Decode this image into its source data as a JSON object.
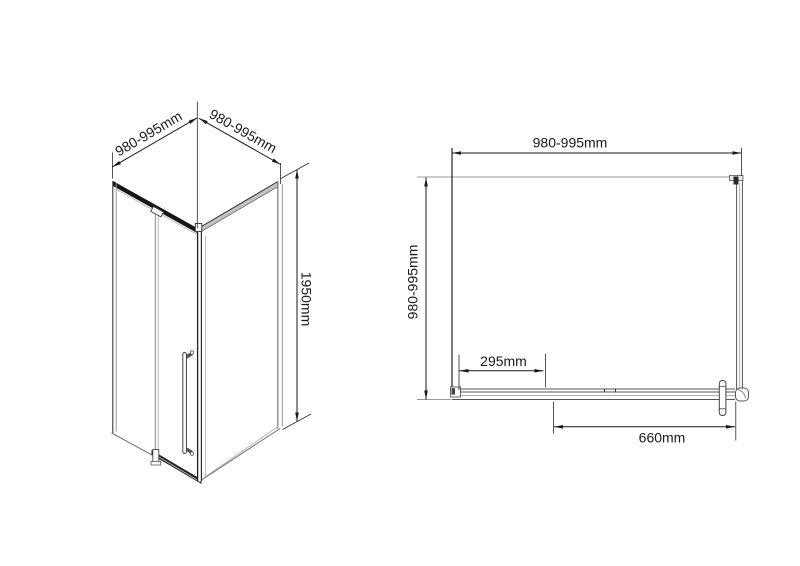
{
  "colors": {
    "background": "#ffffff",
    "line_dark": "#1a1a1a",
    "profile_gray": "#9a9a9a"
  },
  "isometric_view": {
    "dim_top_left": "980-995mm",
    "dim_top_right": "980-995mm",
    "dim_height": "1950mm"
  },
  "plan_view": {
    "dim_width_top": "980-995mm",
    "dim_depth_left": "980-995mm",
    "dim_panel_offset": "295mm",
    "dim_door_width": "660mm"
  }
}
